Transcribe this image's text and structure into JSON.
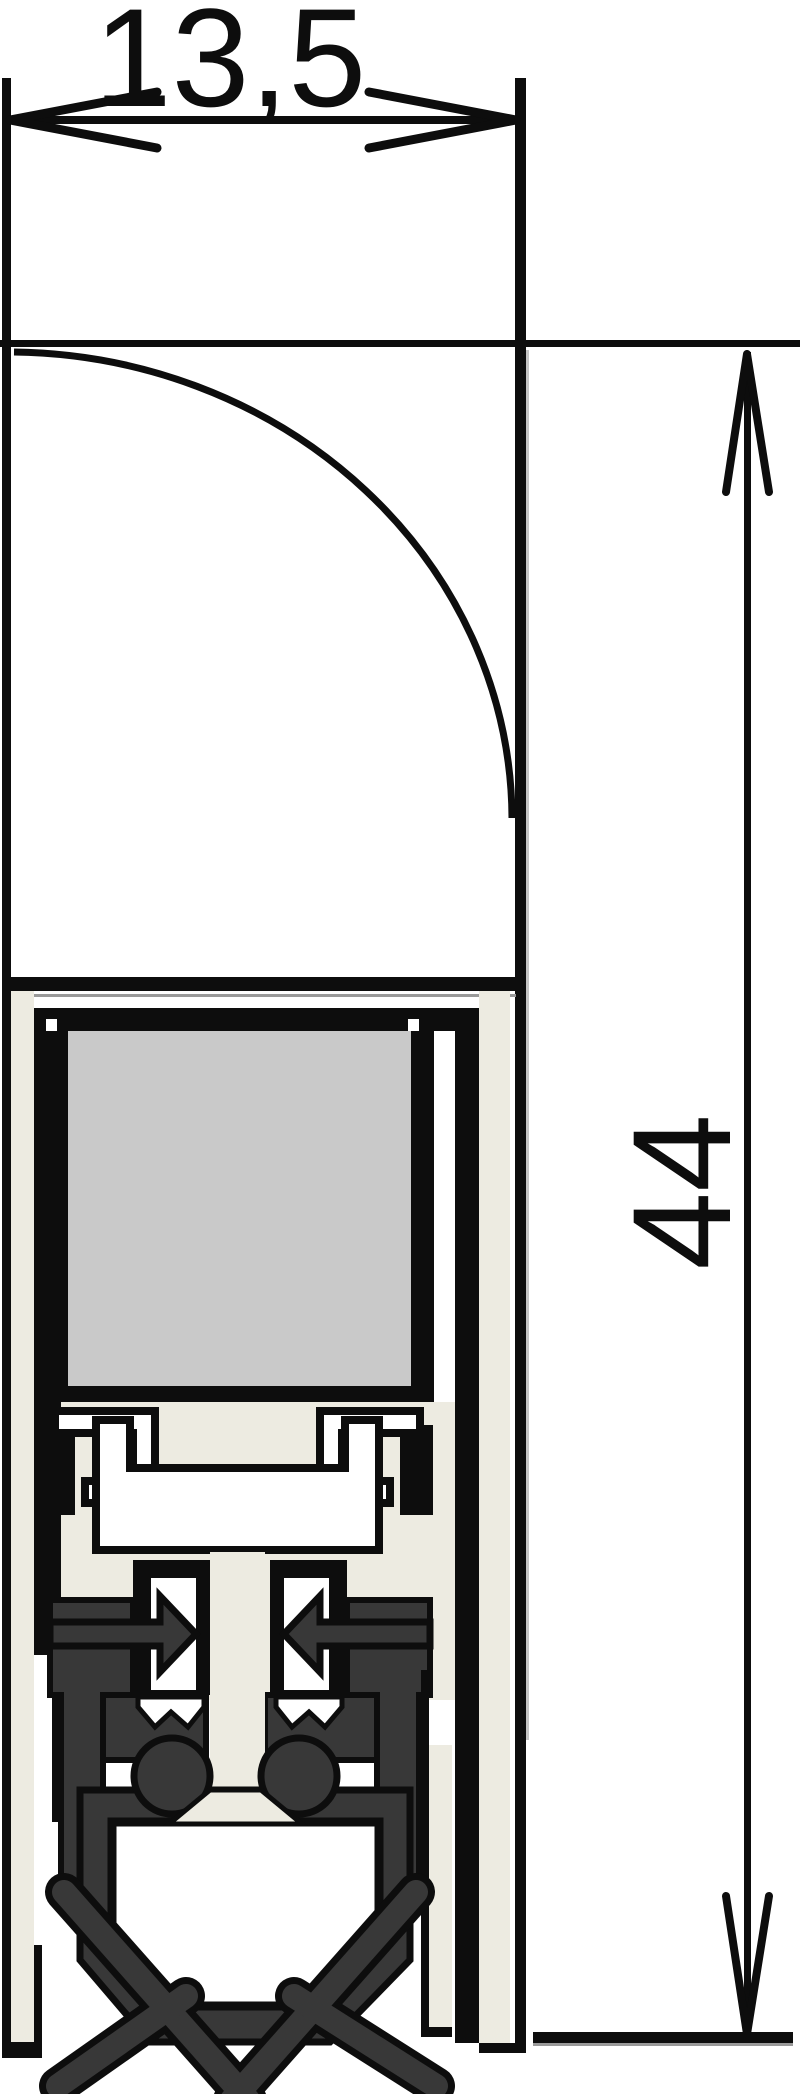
{
  "diagram": {
    "type": "technical-cross-section-drawing",
    "dimensions": {
      "width_label": "13,5",
      "height_label": "44"
    },
    "colors": {
      "bg": "#ffffff",
      "line": "#0d0d0d",
      "white": "#ffffff",
      "beige": "#edebe1",
      "gray": "#c9c9c9",
      "rubber": "#383838",
      "shadow": "#999999",
      "shadow2": "#c4c4c4"
    }
  }
}
